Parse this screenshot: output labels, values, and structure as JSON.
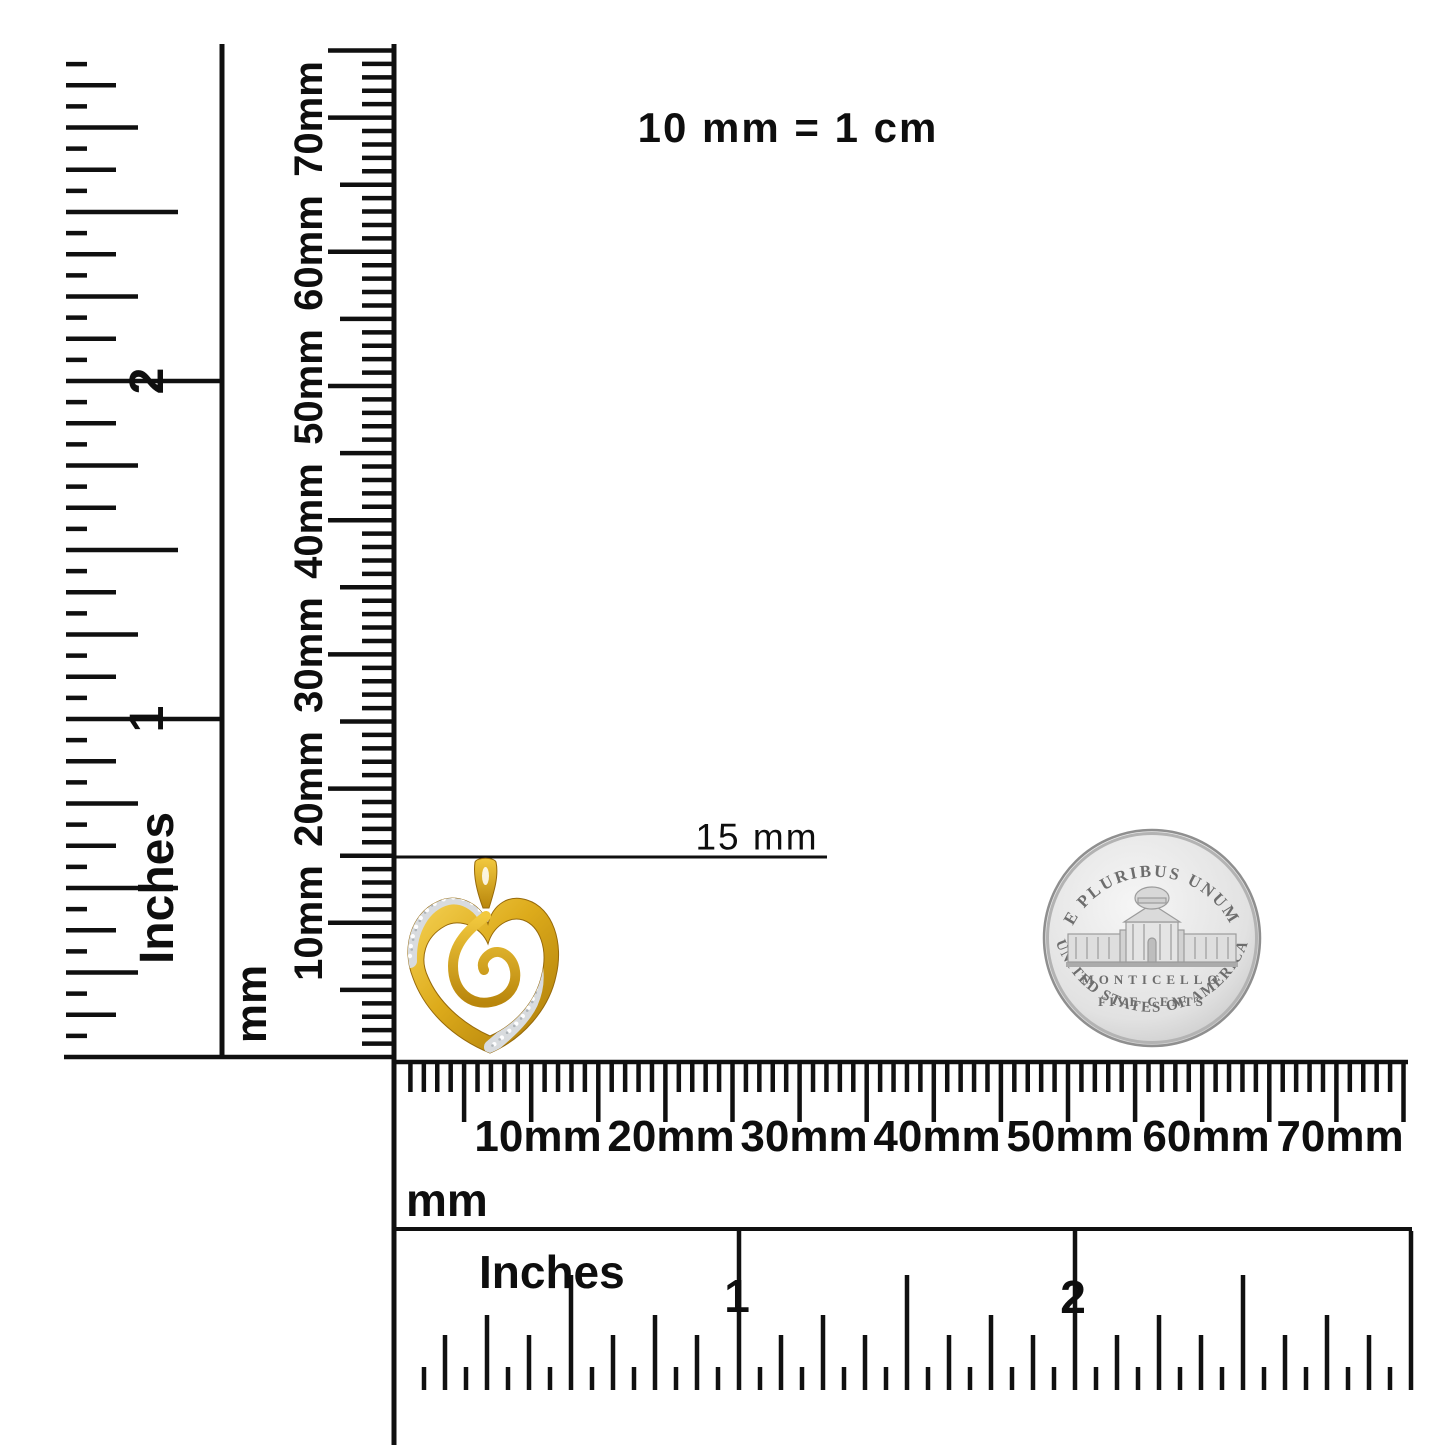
{
  "note": {
    "text": "10 mm = 1 cm"
  },
  "measurement": {
    "label": "15 mm"
  },
  "rulers": {
    "left_inches": {
      "unit": "Inches",
      "marks": [
        "1",
        "2"
      ]
    },
    "left_mm": {
      "unit": "mm",
      "marks": [
        "10mm",
        "20mm",
        "30mm",
        "40mm",
        "50mm",
        "60mm",
        "70mm"
      ]
    },
    "bottom_mm": {
      "unit": "mm",
      "marks": [
        "10mm",
        "20mm",
        "30mm",
        "40mm",
        "50mm",
        "60mm",
        "70mm"
      ]
    },
    "bottom_inches": {
      "unit": "Inches",
      "marks": [
        "1",
        "2"
      ]
    }
  },
  "coin": {
    "legend_top": "E PLURIBUS UNUM",
    "building_label": "MONTICELLO",
    "denomination": "FIVE CENTS",
    "legend_bottom": "UNITED STATES OF AMERICA"
  }
}
